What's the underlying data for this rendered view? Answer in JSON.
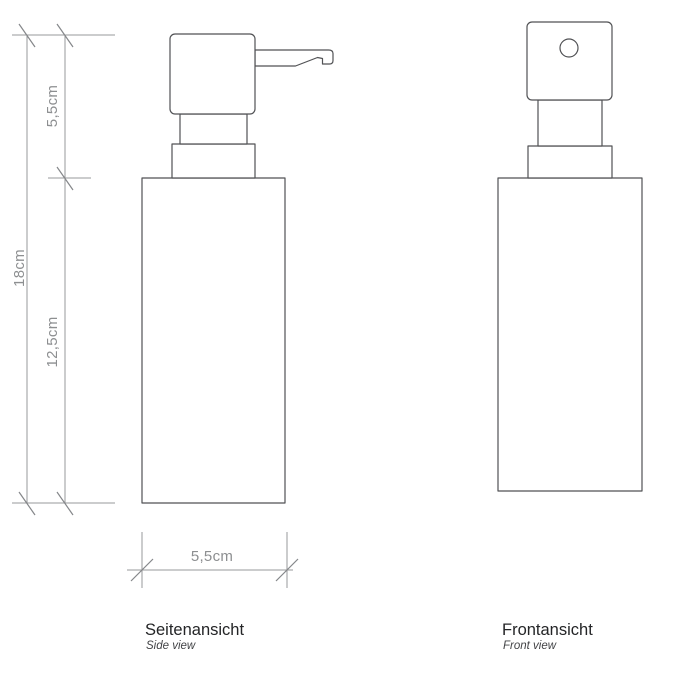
{
  "diagram": {
    "subject": "soap-dispenser-dimension-drawing",
    "views": {
      "side": {
        "title": "Seitenansicht",
        "subtitle": "Side view"
      },
      "front": {
        "title": "Frontansicht",
        "subtitle": "Front view"
      }
    },
    "dimensions": {
      "pump_height": "5,5cm",
      "total_height": "18cm",
      "body_height": "12,5cm",
      "body_width": "5,5cm"
    },
    "colors": {
      "outline": "#515255",
      "dimension_line": "#97999b",
      "dimension_text": "#8d8f91",
      "title_text": "#242527",
      "subtitle_text": "#424346",
      "background": "#ffffff"
    }
  }
}
